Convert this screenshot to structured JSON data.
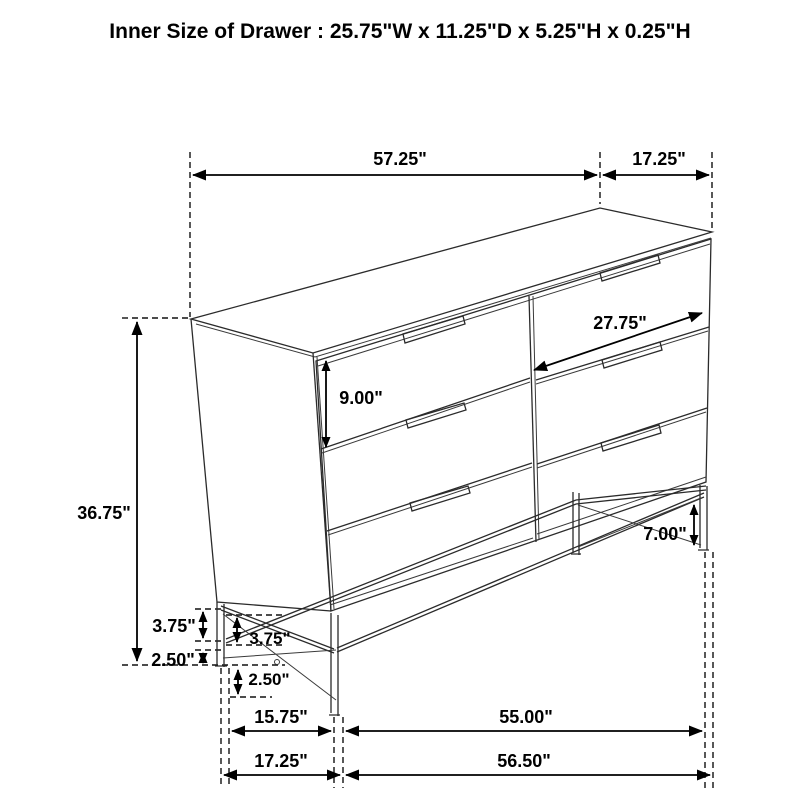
{
  "title": "Inner Size of Drawer : 25.75\"W x 11.25\"D x 5.25\"H x 0.25\"H",
  "figure": "six-drawer-dresser-line-drawing",
  "colors": {
    "line": "#2b2b2b",
    "text": "#000000",
    "background": "#ffffff"
  },
  "dimensions": {
    "top_width": "57.25\"",
    "top_depth": "17.25\"",
    "overall_height": "36.75\"",
    "drawer_front_height": "9.00\"",
    "drawer_inner_width": "27.75\"",
    "leg_height": "7.00\"",
    "base_upper_outer": "3.75\"",
    "base_lower_outer": "2.50\"",
    "base_upper_inner": "3.75\"",
    "base_lower_inner": "2.50\"",
    "base_depth_inner": "15.75\"",
    "base_width_inner": "55.00\"",
    "base_depth_outer": "17.25\"",
    "base_width_outer": "56.50\""
  }
}
